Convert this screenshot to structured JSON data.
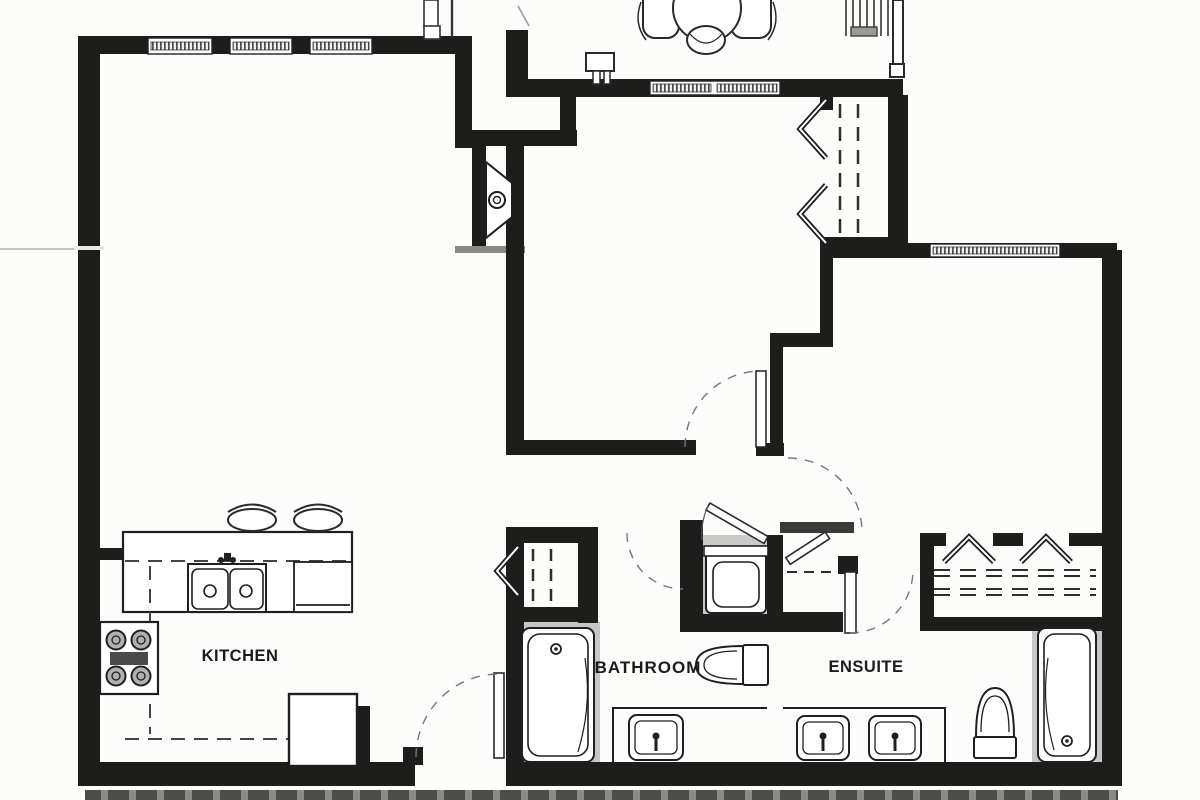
{
  "plan": {
    "type": "apartment-floor-plan-scan",
    "labels": {
      "kitchen": "KITCHEN",
      "bathroom": "BATHROOM",
      "ensuite": "ENSUITE"
    },
    "fixtures": [
      "patio-table-icon",
      "patio-chair-icon",
      "bbq-icon",
      "stairs-icon",
      "railing-icon",
      "water-heater-icon",
      "window-icon",
      "bifold-closet-door-icon",
      "door-swing-icon",
      "kitchen-double-sink-icon",
      "dishwasher-icon",
      "stove-burners-icon",
      "refrigerator-icon",
      "bar-stool-icon",
      "bathtub-icon",
      "toilet-icon",
      "vanity-sink-icon",
      "washer-icon",
      "closet-shelf-dashes-icon"
    ],
    "colors": {
      "wall": "#1d1d1c",
      "paper": "#fcfcfb",
      "fixture_surround_gray": "#c6c6c4",
      "niche_gray": "#c9c9c7",
      "scan_strip_dark": "#4c4c4a",
      "scan_strip_light": "#8a8a86",
      "dash_line": "#3a3a38"
    }
  }
}
